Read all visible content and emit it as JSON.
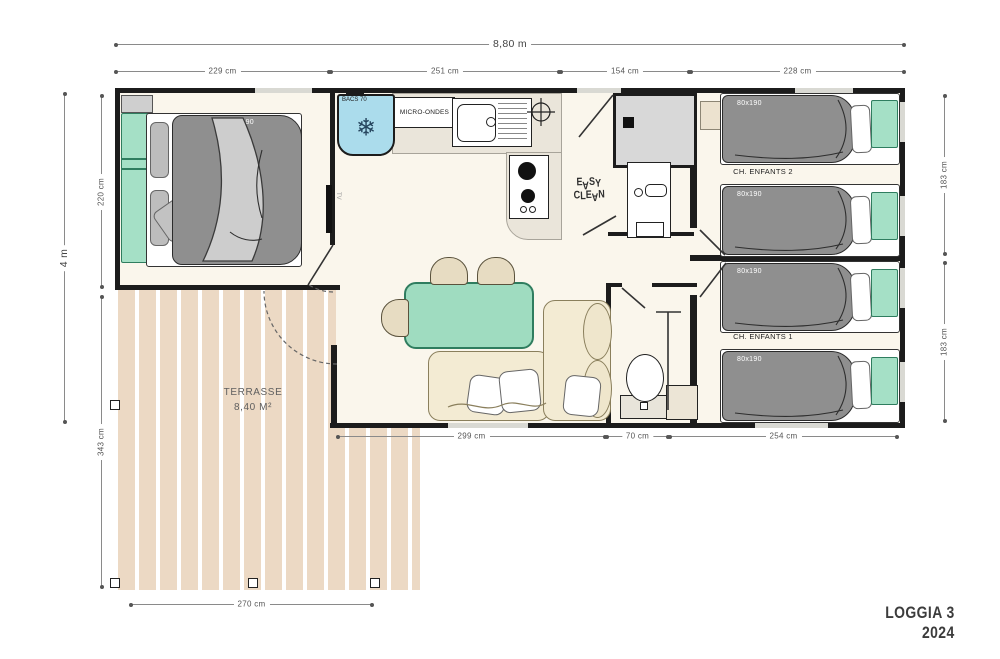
{
  "plan": {
    "title_line1": "LOGGIA 3",
    "title_line2": "2024"
  },
  "dims": {
    "top_total": "8,80 m",
    "top_seg_1": "229 cm",
    "top_seg_2": "251 cm",
    "top_seg_3": "154 cm",
    "top_seg_4": "228 cm",
    "left_total": "4 m",
    "left_seg_1": "220 cm",
    "left_seg_2": "343 cm",
    "right_seg_1": "183 cm",
    "right_seg_2": "183 cm",
    "bottom_seg_1": "299 cm",
    "bottom_seg_2": "70 cm",
    "bottom_seg_3": "254 cm",
    "terrace_width": "270 cm"
  },
  "rooms": {
    "master_bedroom": {
      "bed_size": "140x190",
      "tv": "TV"
    },
    "kitchen": {
      "fridge": "BACS 70",
      "microwave": "MICRO-ONDES"
    },
    "bathroom": {
      "logo_top": "EASY",
      "logo_bottom": "CLEAN"
    },
    "kids_room_2": {
      "name": "CH. ENFANTS 2",
      "bed_1": "80x190",
      "bed_2": "80x190"
    },
    "kids_room_1": {
      "name": "CH. ENFANTS 1",
      "bed_1": "80x190",
      "bed_2": "80x190"
    },
    "terrace": {
      "name": "TERRASSE",
      "area": "8,40 M²"
    }
  },
  "colors": {
    "wall": "#1c1c1c",
    "floor": "#faf6ec",
    "accent_teal": "#a5e0c6",
    "fridge_blue": "#abdcec",
    "duvet_gray": "#8f8f8f",
    "sofa_beige": "#f3ebd3",
    "terrace_tan": "#ecd9c4"
  }
}
